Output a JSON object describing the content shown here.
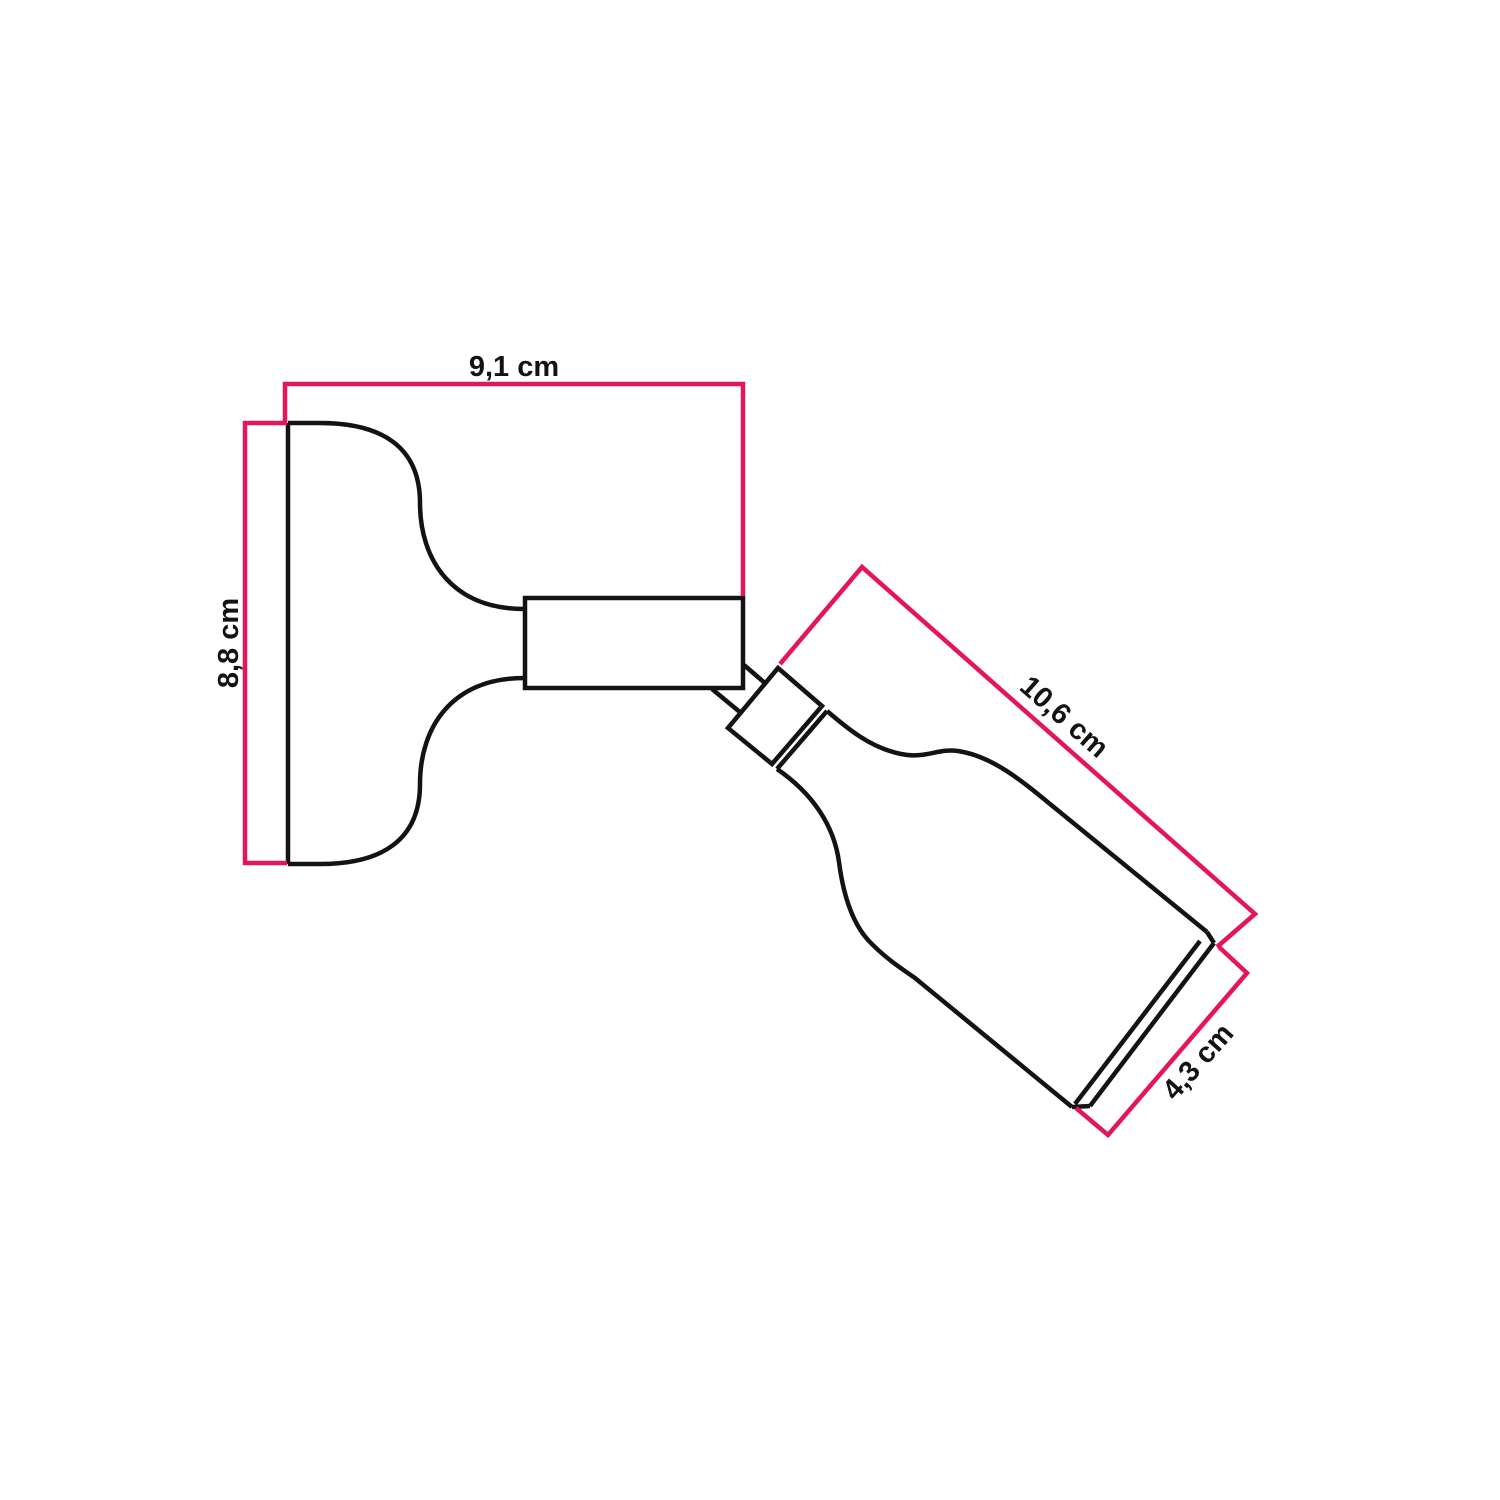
{
  "diagram": {
    "kind": "product-dimension-drawing",
    "subject": "adjustable-wall-spotlight-side-view",
    "colors": {
      "dimension_line": "#e4145e",
      "outline": "#131313",
      "background": "#ffffff"
    },
    "dimensions": [
      {
        "id": "base-width",
        "label": "9,1 cm",
        "orientation": "horizontal"
      },
      {
        "id": "base-height",
        "label": "8,8 cm",
        "orientation": "vertical"
      },
      {
        "id": "spot-length",
        "label": "10,6 cm",
        "orientation": "diagonal"
      },
      {
        "id": "spot-diameter",
        "label": "4,3 cm",
        "orientation": "diagonal"
      }
    ]
  }
}
